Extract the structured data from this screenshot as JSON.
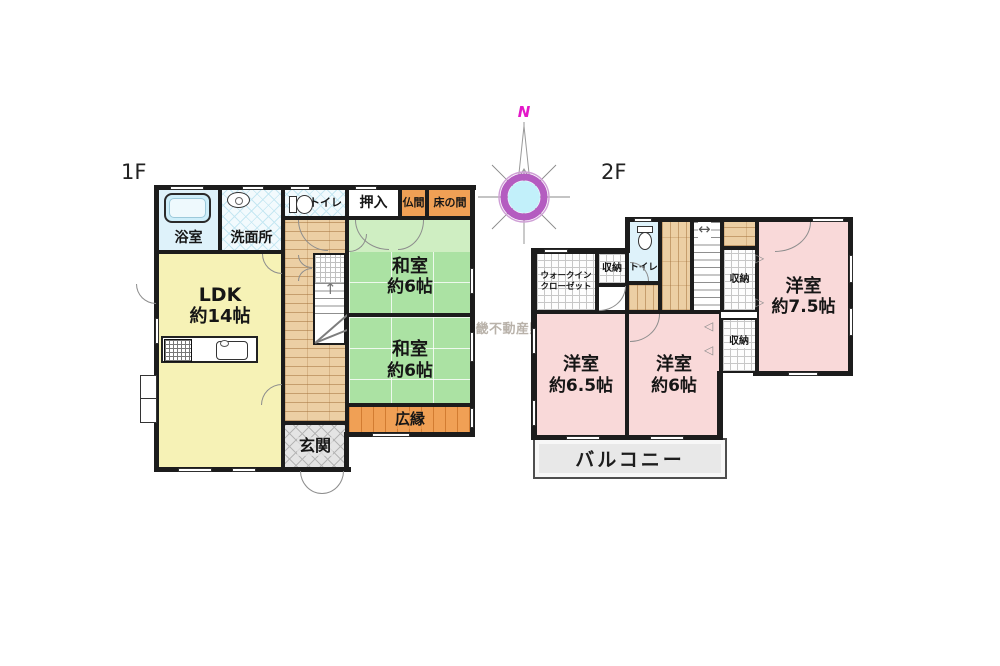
{
  "floor1": {
    "label": "1F",
    "rooms": {
      "bathroom": {
        "label": "浴室"
      },
      "washroom": {
        "label": "洗面所"
      },
      "toilet": {
        "label": "トイレ"
      },
      "oshiire": {
        "label": "押入"
      },
      "butsuma": {
        "label": "仏間"
      },
      "tokonoma": {
        "label": "床の間"
      },
      "ldk": {
        "name": "LDK",
        "size": "約14帖"
      },
      "washitsu_upper": {
        "name": "和室",
        "size": "約6帖"
      },
      "washitsu_lower": {
        "name": "和室",
        "size": "約6帖"
      },
      "hiroen": {
        "label": "広縁"
      },
      "genkan": {
        "label": "玄関"
      }
    }
  },
  "floor2": {
    "label": "2F",
    "rooms": {
      "walkin_closet": {
        "line1": "ウォークイン",
        "line2": "クローゼット"
      },
      "storage_upper_left": {
        "label": "収納"
      },
      "toilet": {
        "label": "トイレ"
      },
      "storage_upper_right": {
        "label": "収納"
      },
      "storage_middle": {
        "label": "収納"
      },
      "yoshitsu_75": {
        "name": "洋室",
        "size": "約7.5帖"
      },
      "yoshitsu_65": {
        "name": "洋室",
        "size": "約6.5帖"
      },
      "yoshitsu_6": {
        "name": "洋室",
        "size": "約6帖"
      },
      "balcony": {
        "label": "バルコニー"
      }
    }
  },
  "compass": {
    "north_label": "N"
  },
  "watermark": {
    "prefix_line1": "株式",
    "prefix_line2": "会社",
    "name": "近畿不動産販売"
  },
  "symbols": {
    "stairs_up_arrow": "↑",
    "stairs_double_arrow": "↔",
    "folding_door_left": "◁",
    "folding_door_right": "▷"
  },
  "colors": {
    "wall": "#1c1c1c",
    "tatami_green": "#abe2a3",
    "ldk_yellow": "#f6f2b6",
    "western_pink": "#f9d9d9",
    "wood_tan": "#eccfa4",
    "alcove_orange": "#f0a055",
    "wet_cyan": "#def2fa",
    "balcony_gray": "#e8e8e8",
    "compass_ring": "#b45cc0",
    "compass_center": "#c2f0fa",
    "north_magenta": "#e318c8"
  }
}
